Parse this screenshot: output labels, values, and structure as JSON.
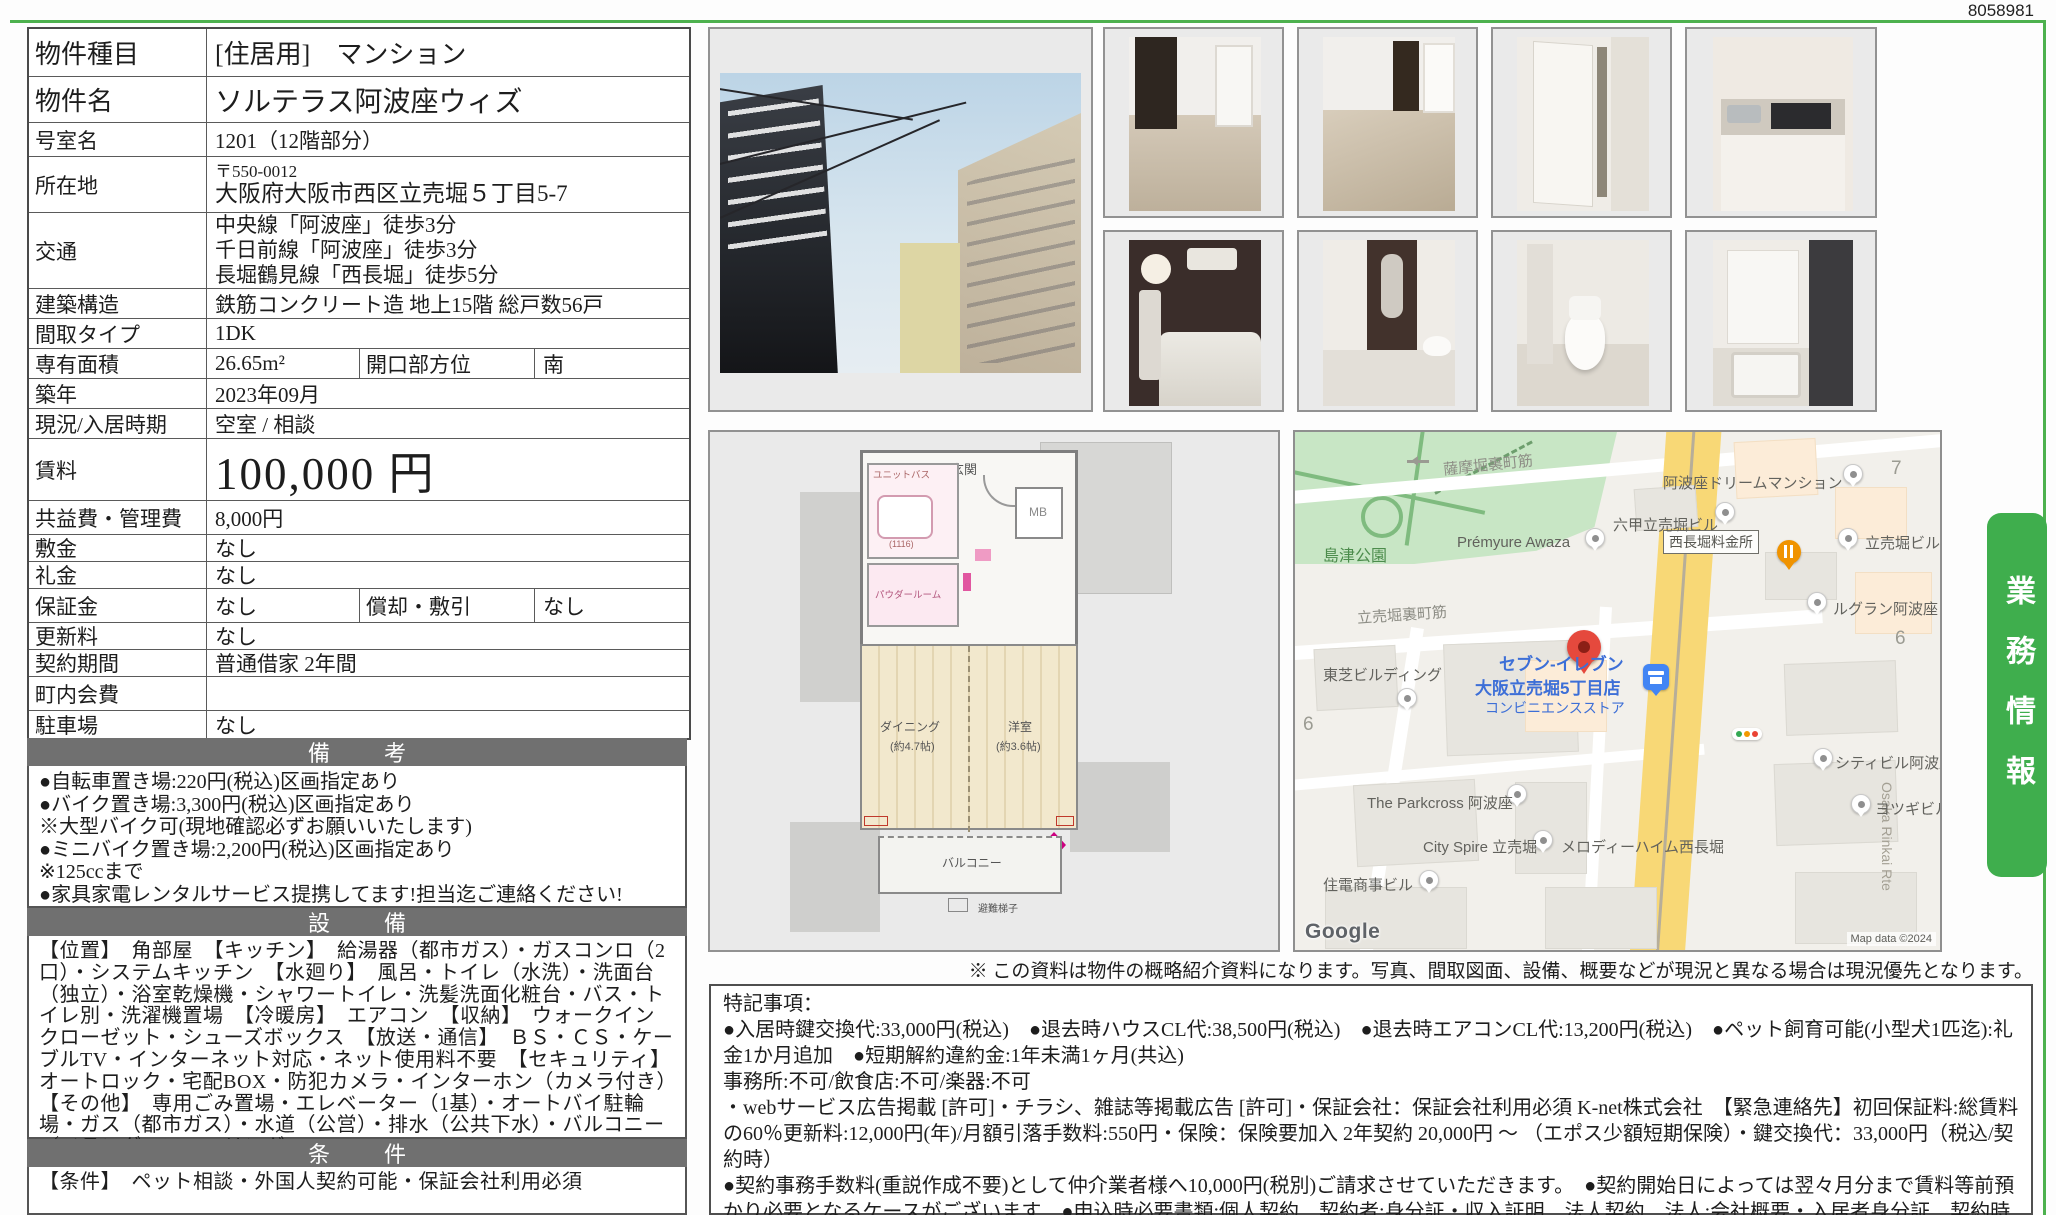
{
  "doc_number": "8058981",
  "side_tab": {
    "label": "業務情報"
  },
  "colors": {
    "accent_green": "#3fae4d",
    "section_bar_gray": "#707070",
    "map_road_yellow": "#f8d876",
    "store_name_blue": "#3d6fd7",
    "destination_pin_red": "#e5493d"
  },
  "table": {
    "rows": [
      {
        "label": "物件種目",
        "value": "[住居用]　マンション"
      },
      {
        "label": "物件名",
        "value": "ソルテラス阿波座ウィズ"
      },
      {
        "label": "号室名",
        "value": "1201（12階部分）"
      },
      {
        "label": "所在地",
        "postal": "〒550-0012",
        "value": "大阪府大阪市西区立売堀５丁目5-7"
      },
      {
        "label": "交通",
        "lines": [
          "中央線「阿波座」徒歩3分",
          "千日前線「阿波座」徒歩3分",
          "長堀鶴見線「西長堀」徒歩5分"
        ]
      },
      {
        "label": "建築構造",
        "value": "鉄筋コンクリート造 地上15階 総戸数56戸"
      },
      {
        "label": "間取タイプ",
        "value": "1DK"
      },
      {
        "label": "専有面積",
        "value": "26.65m²",
        "label2": "開口部方位",
        "value2": "南"
      },
      {
        "label": "築年",
        "value": "2023年09月"
      },
      {
        "label": "現況/入居時期",
        "value": "空室 /  相談"
      },
      {
        "label": "賃料",
        "value": "100,000 円"
      },
      {
        "label": "共益費・管理費",
        "value": "8,000円"
      },
      {
        "label": "敷金",
        "value": "なし"
      },
      {
        "label": "礼金",
        "value": "なし"
      },
      {
        "label": "保証金",
        "value": "なし",
        "label2": "償却・敷引",
        "value2": "なし"
      },
      {
        "label": "更新料",
        "value": "なし"
      },
      {
        "label": "契約期間",
        "value": "普通借家 2年間"
      },
      {
        "label": "町内会費",
        "value": ""
      },
      {
        "label": "駐車場",
        "value": "なし"
      }
    ]
  },
  "remarks": {
    "header": "備　考",
    "lines": [
      "●自転車置き場:220円(税込)区画指定あり",
      "●バイク置き場:3,300円(税込)区画指定あり",
      "※大型バイク可(現地確認必ずお願いいたします)",
      "●ミニバイク置き場:2,200円(税込)区画指定あり",
      "※125ccまで",
      "●家具家電レンタルサービス提携してます!担当迄ご連絡ください!"
    ]
  },
  "equipment": {
    "header": "設　備",
    "text": "【位置】　角部屋　【キッチン】　給湯器（都市ガス）・ガスコンロ（2口）・システムキッチン　【水廻り】　風呂・トイレ（水洗）・洗面台（独立）・浴室乾燥機・シャワートイレ・洗髪洗面化粧台・バス・トイレ別・洗濯機置場　【冷暖房】　エアコン　【収納】　ウォークインクローゼット・シューズボックス　【放送・通信】　ＢＳ・ＣＳ・ケーブルTV・インターネット対応・ネット使用料不要　【セキュリティ】　オートロック・宅配BOX・防犯カメラ・インターホン（カメラ付き）　【その他】　専用ごみ置場・エレベーター（1基）・オートバイ駐輪場・ガス（都市ガス）・水道（公営）・排水（公共下水）・バルコニー／ベランダ・フローリング"
  },
  "conditions": {
    "header": "条　件",
    "text": "【条件】　ペット相談・外国人契約可能・保証会社利用必須"
  },
  "disclaimer": "※ この資料は物件の概略紹介資料になります。写真、間取図面、設備、概要などが現況と異なる場合は現況優先となります。",
  "special_notes": {
    "title": "特記事項：",
    "paragraphs": [
      "●入居時鍵交換代:33,000円(税込)　●退去時ハウスCL代:38,500円(税込)　●退去時エアコンCL代:13,200円(税込)　●ペット飼育可能(小型犬1匹迄):礼金1か月追加　●短期解約違約金:1年未満1ヶ月(共込)",
      "事務所:不可/飲食店:不可/楽器:不可",
      "・webサービス広告掲載 [許可]・チラシ、雑誌等掲載広告 [許可]・保証会社：保証会社利用必須 K-net株式会社　【緊急連絡先】初回保証料:総賃料の60％更新料:12,000円(年)/月額引落手数料:550円・保険：保険要加入 2年契約 20,000円 ～ （エポス少額短期保険）・鍵交換代：33,000円（税込/契約時）",
      "●契約事務手数料(重説作成不要)として仲介業者様へ10,000円(税別)ご請求させていただきます。　●契約開始日によっては翌々月分まで賃料等前預かり必要となるケースがございます　●申込時必要書類:個人契約　契約者:身分証・収入証明　法人契約　法人:会社概要・入居者身分証　契約時必要書類:身分証コピー　収入証明コピー　住民票　顔写真　印鑑証明　※すべて契約者のもの"
    ]
  },
  "floor_plan": {
    "labels": {
      "genkan": "玄関",
      "mb": "MB",
      "unit_bath": "ユニットバス",
      "unit_bath_size": "(1116)",
      "powder": "パウダールーム",
      "dining": "ダイニング",
      "dining_size": "(約4.7帖)",
      "bedroom": "洋室",
      "bedroom_size": "(約3.6帖)",
      "balcony": "バルコニー",
      "ladder": "避難梯子"
    }
  },
  "map": {
    "streets": {
      "s1": "薩摩堀裏町筋",
      "s2": "立売堀裏町筋"
    },
    "park": "島津公園",
    "toll": "西長堀料金所",
    "road_label": "Osaka Rinkai Rte",
    "pois": {
      "rokko": "六甲立売堀ビル",
      "dream": "阿波座ドリームマンション",
      "premyure": "Prémyure Awaza",
      "itachibori_bldg": "立売堀ビル",
      "legrand": "ルグラン阿波座",
      "toshiba": "東芝ビルディング",
      "seven1": "セブン-イレブン",
      "seven2": "大阪立売堀5丁目店",
      "seven3": "コンビニエンスストア",
      "city_bldg": "シティビル阿波座",
      "parkcross": "The Parkcross 阿波座",
      "cityspire": "City Spire 立売堀",
      "melody": "メロディーハイム西長堀",
      "yotsugi": "ヨツギビル",
      "juden": "住電商事ビル"
    },
    "numbers": {
      "n7": "7",
      "n6a": "6",
      "n6b": "6"
    },
    "google": "Google",
    "copyright": "Map data ©2024"
  }
}
